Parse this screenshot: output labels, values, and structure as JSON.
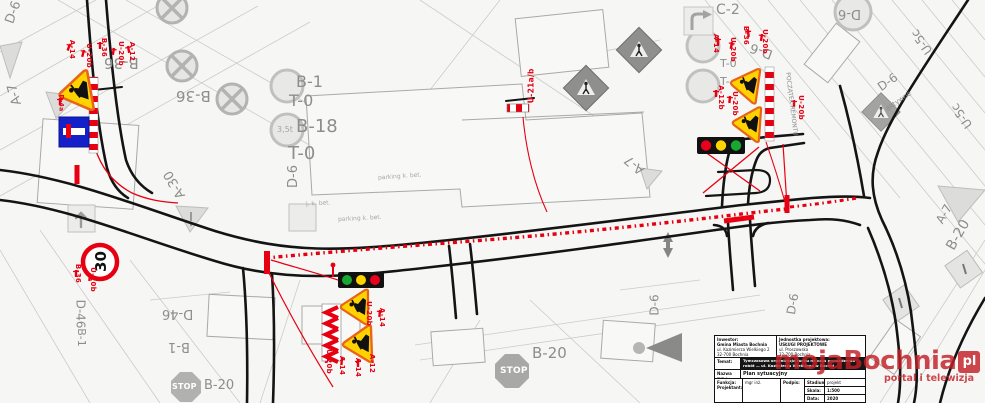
{
  "document": {
    "type": "temporary-traffic-organization-plan",
    "watermark": {
      "brand": "mojaBochnia",
      "suffix": "pl",
      "tagline": "portal i telewizja",
      "color": "#c21f25"
    }
  },
  "colors": {
    "overlay_red": "#e60012",
    "sign_yellow": "#ffd200",
    "sign_border_orange": "#e8641a",
    "sign_blue": "#1420c8",
    "light_red": "#e8001d",
    "light_yellow": "#ffd400",
    "light_green": "#17a832",
    "road_black": "#141414",
    "base_gray": "#c9c9c7",
    "label_gray": "#8d8d8b"
  },
  "signs": {
    "traffic_light_right": {
      "lights": [
        "red",
        "yellow",
        "green"
      ]
    },
    "traffic_light_center": {
      "lights": [
        "green",
        "yellow",
        "red"
      ]
    },
    "speed_limit": {
      "value": "30"
    },
    "codes_visible": [
      "A-7",
      "A-12",
      "A-14",
      "A-30",
      "B-1",
      "B-18",
      "B-20",
      "B-36",
      "C-2",
      "D-4a",
      "D-6",
      "D-46",
      "T-0",
      "U-3",
      "U-5c",
      "U-20b",
      "U-21a/b",
      "3.5t",
      "STOP"
    ]
  },
  "labels": {
    "gray": [
      {
        "text": "B-36"
      },
      {
        "text": "B-36"
      },
      {
        "text": "B-1"
      },
      {
        "text": "T-0"
      },
      {
        "text": "B-18"
      },
      {
        "text": "T-0"
      },
      {
        "text": "3,5t"
      },
      {
        "text": "D-6"
      },
      {
        "text": "A-30"
      },
      {
        "text": "A-7"
      },
      {
        "text": "D-6"
      },
      {
        "text": "C-2"
      },
      {
        "text": "T-0"
      },
      {
        "text": "T-"
      },
      {
        "text": "D-6"
      },
      {
        "text": "D-6"
      },
      {
        "text": "U-5c"
      },
      {
        "text": "U-5c"
      },
      {
        "text": "D-6"
      },
      {
        "text": "aktywne"
      },
      {
        "text": "POCZĄTEK REMONTU"
      },
      {
        "text": "A-7"
      },
      {
        "text": "A-7"
      },
      {
        "text": "B-20"
      },
      {
        "text": "D-6"
      },
      {
        "text": "D-6"
      },
      {
        "text": "D-46"
      },
      {
        "text": "B-1"
      },
      {
        "text": "B-20"
      },
      {
        "text": "D-46"
      },
      {
        "text": "B-1"
      },
      {
        "text": "B-20"
      },
      {
        "text": "parking k. bet."
      },
      {
        "text": "parking k. bet."
      },
      {
        "text": "j. k. bet."
      }
    ],
    "red": [
      {
        "text": "A-14"
      },
      {
        "text": "U-20b"
      },
      {
        "text": "B-36"
      },
      {
        "text": "U-20b"
      },
      {
        "text": "A-12"
      },
      {
        "text": "D-4a"
      },
      {
        "text": "U-21a/b"
      },
      {
        "text": "A-14"
      },
      {
        "text": "U-20b"
      },
      {
        "text": "B-36"
      },
      {
        "text": "U-20b"
      },
      {
        "text": "A-12b"
      },
      {
        "text": "U-20b"
      },
      {
        "text": "U-20b"
      },
      {
        "text": "U-20b"
      },
      {
        "text": "A-14"
      },
      {
        "text": "U-20b"
      },
      {
        "text": "A-14"
      },
      {
        "text": "A-14"
      },
      {
        "text": "A-12"
      },
      {
        "text": "B-36"
      },
      {
        "text": "U-20b"
      }
    ],
    "stop_1": "STOP",
    "stop_2": "STOP",
    "speed_30": "30"
  },
  "title_block": {
    "inwestor_label": "Inwestor:",
    "inwestor_name": "Gmina Miasta Bochnia",
    "inwestor_addr1": "ul. Kazimierza Wielkiego 2",
    "inwestor_addr2": "32-700 Bochnia",
    "jednostka_label": "Jednostka projektowa:",
    "jednostka_name": "USŁUGI PROJEKTOWE",
    "jednostka_addr1": "ul. Proszowska",
    "jednostka_addr2": "32-700 Bochnia",
    "temat_label": "Temat:",
    "temat_text": "Tymczasowa organizacja ruchu na czas prowadzenia robót — ul. Kazimierza Wielkiego w Bochni",
    "rysunek_label": "Nazwa rys.:",
    "rysunek_text": "Plan sytuacyjny",
    "funkcja_label": "Funkcja:",
    "projektant_label": "Projektant:",
    "projektant_name": "mgr inż.",
    "podpis_label": "Podpis:",
    "stadium_label": "Stadium:",
    "stadium_value": "projekt",
    "skala_label": "Skala:",
    "skala_value": "1:500",
    "data_label": "Data:",
    "data_value": "2020"
  }
}
